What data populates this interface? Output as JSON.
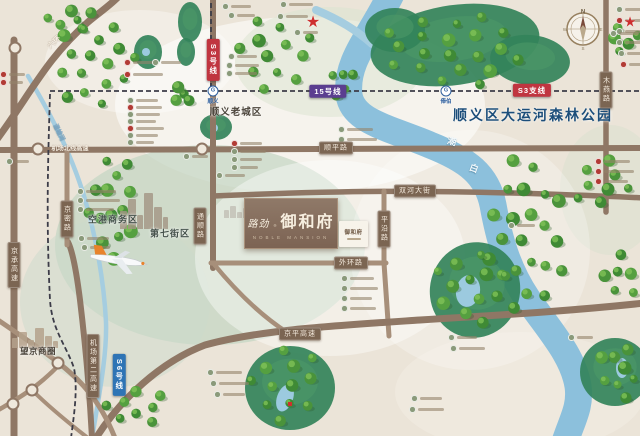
{
  "meta": {
    "title": "路劲御和府 区位示意图"
  },
  "brand": {
    "prefix": "路劲",
    "reg": "®",
    "name": "御和府",
    "en": "NOBLE MANSION",
    "card_name": "御和府"
  },
  "compass": {
    "n": "N",
    "e": "E",
    "s": "S",
    "w": "W"
  },
  "region_labels": [
    {
      "text": "顺义老城区",
      "x": 236,
      "y": 111,
      "size": 9.5,
      "color": "#4a4339",
      "ls": 1
    },
    {
      "text": "顺义区大运河森林公园",
      "x": 533,
      "y": 115,
      "size": 14,
      "color": "#1c4e7a",
      "ls": 2
    },
    {
      "text": "空港商务区",
      "x": 113,
      "y": 219,
      "size": 9,
      "color": "#44514a",
      "ls": 1
    },
    {
      "text": "第七街区",
      "x": 170,
      "y": 233,
      "size": 9,
      "color": "#44514a",
      "ls": 1
    },
    {
      "text": "望京商圈",
      "x": 38,
      "y": 351,
      "size": 8.5,
      "color": "#4a4339",
      "ls": 0.5
    }
  ],
  "river_labels": [
    {
      "text": "潮",
      "x": 452,
      "y": 141,
      "rot": 15,
      "size": 9
    },
    {
      "text": "白",
      "x": 474,
      "y": 168,
      "rot": 20,
      "size": 9
    },
    {
      "text": "温榆河",
      "x": 60,
      "y": 132,
      "rot": 64,
      "size": 6
    }
  ],
  "road_pills": [
    {
      "text": "顺平路",
      "x": 336,
      "y": 148,
      "v": false
    },
    {
      "text": "双河大街",
      "x": 415,
      "y": 191,
      "v": false
    },
    {
      "text": "外环路",
      "x": 351,
      "y": 263,
      "v": false
    },
    {
      "text": "京平高速",
      "x": 300,
      "y": 334,
      "v": false
    },
    {
      "text": "京承高速",
      "x": 14,
      "y": 265,
      "v": true
    },
    {
      "text": "京密路",
      "x": 67,
      "y": 219,
      "v": true
    },
    {
      "text": "通顺路",
      "x": 200,
      "y": 226,
      "v": true
    },
    {
      "text": "机场第二高速",
      "x": 93,
      "y": 366,
      "v": true
    },
    {
      "text": "平沿路",
      "x": 384,
      "y": 229,
      "v": true
    },
    {
      "text": "木燕路",
      "x": 606,
      "y": 90,
      "v": true
    }
  ],
  "road_texts": [
    {
      "text": "六环",
      "x": 54,
      "y": 42,
      "rot": -42,
      "size": 7.5
    },
    {
      "text": "机场北线高速",
      "x": 70,
      "y": 148,
      "rot": 0,
      "size": 6.2
    }
  ],
  "metro_pills": [
    {
      "text": "S3号线",
      "x": 213,
      "y": 60,
      "v": true,
      "bg": "#c03540"
    },
    {
      "text": "15号线",
      "x": 328,
      "y": 91,
      "v": false,
      "bg": "#5b3e90"
    },
    {
      "text": "S3支线",
      "x": 532,
      "y": 90,
      "v": false,
      "bg": "#c03540"
    },
    {
      "text": "S6号线",
      "x": 119,
      "y": 375,
      "v": true,
      "bg": "#2e74b5"
    }
  ],
  "stations": [
    {
      "name": "顺义",
      "x": 213,
      "y": 91
    },
    {
      "name": "俸伯",
      "x": 446,
      "y": 91
    }
  ],
  "stars": [
    {
      "x": 313,
      "y": 22,
      "s": 16
    },
    {
      "x": 630,
      "y": 22,
      "s": 14
    }
  ],
  "palette": {
    "bg": "#ebe4d8",
    "road": "#8f7765",
    "road_minor": "#a78f7a",
    "river": "#8cc0dc",
    "stream": "#a5cde0",
    "park": "#33835a",
    "park_light": "#4f9a68",
    "pond": "#9ccadf",
    "tree_shadow": "#2b5a28",
    "tree": [
      "#3f8a35",
      "#55a040",
      "#4a933b"
    ],
    "tree_hi": "#7fc258",
    "metro_dash": "#3c3c48",
    "accent_red": "#ce2f2f"
  },
  "geometry": {
    "zones": [
      [
        300,
        105,
        185,
        88,
        "#ffffff",
        0.55,
        0
      ],
      [
        330,
        62,
        95,
        55,
        "#d9e3cf",
        0.5,
        0
      ],
      [
        210,
        245,
        155,
        100,
        "#c3d6c4",
        0.72,
        0
      ],
      [
        115,
        302,
        95,
        85,
        "#cbdacb",
        0.5,
        0
      ],
      [
        330,
        258,
        135,
        98,
        "#ffffff",
        0.4,
        0
      ],
      [
        610,
        190,
        50,
        65,
        "#d5dfcc",
        0.4,
        0
      ],
      [
        140,
        62,
        95,
        52,
        "#ffffff",
        0.35,
        0
      ],
      [
        520,
        392,
        125,
        60,
        "#f3ede3",
        0.5,
        0
      ],
      [
        470,
        250,
        120,
        120,
        "#ffffff",
        0.25,
        0
      ]
    ],
    "rivers": [
      [
        "M393,-10 C372,35 345,60 349,95 C353,122 390,128 430,145 C468,160 487,175 493,205 C499,238 507,268 527,298 C549,330 573,355 578,386 C581,407 572,420 565,442",
        27,
        "river"
      ],
      [
        "M316,10 C340,20 356,30 372,44",
        8,
        "stream"
      ],
      [
        "M28,76 C48,110 70,150 84,196 C96,236 104,282 106,322 C107,354 100,390 92,438",
        4.5,
        "stream"
      ]
    ],
    "parks": [
      [
        455,
        45,
        85,
        40,
        -8
      ],
      [
        395,
        30,
        30,
        22,
        0
      ],
      [
        530,
        60,
        40,
        25,
        5
      ],
      [
        190,
        22,
        12,
        20,
        0
      ],
      [
        186,
        52,
        9,
        14,
        0
      ],
      [
        216,
        127,
        16,
        13,
        0
      ],
      [
        148,
        52,
        14,
        17,
        0
      ],
      [
        475,
        290,
        45,
        48,
        15
      ],
      [
        290,
        388,
        45,
        42,
        0
      ],
      [
        615,
        372,
        35,
        34,
        0
      ]
    ],
    "ponds": [
      [
        214,
        128,
        4,
        4,
        0
      ],
      [
        146,
        52,
        4,
        4,
        0
      ],
      [
        468,
        291,
        12,
        16,
        10
      ],
      [
        285,
        398,
        8,
        14,
        20
      ],
      [
        622,
        368,
        6,
        10,
        0
      ]
    ],
    "roads": [
      [
        "M-5,142 C30,95 45,60 88,22 C100,12 112,4 120,-5",
        7
      ],
      [
        "M14,40 L14,438",
        7
      ],
      [
        "M-5,150 L645,148",
        6
      ],
      [
        "M213,-5 L213,268",
        6
      ],
      [
        "M606,-5 L606,212",
        5.5
      ],
      [
        "M213,196 C330,191 430,188 645,198",
        5.5
      ],
      [
        "M384,191 L384,263 L389,336",
        5
      ],
      [
        "M211,263 L386,263",
        5
      ],
      [
        "M96,438 C120,400 160,362 205,345 C260,330 330,326 420,320 C520,314 580,310 645,303",
        7
      ],
      [
        "M92,438 C90,400 86,350 80,300 C76,268 72,250 68,242",
        6
      ],
      [
        "M67,150 L67,245",
        5
      ],
      [
        "M-5,318 C20,335 45,352 60,364 C80,380 100,400 115,438",
        5
      ],
      [
        "M-5,412 C15,400 35,390 60,364",
        4.5
      ],
      [
        "M32,390 C50,408 70,424 88,438",
        4
      ],
      [
        "M213,263 C235,290 260,315 288,333",
        4.5
      ]
    ],
    "junctions": [
      [
        15,
        48
      ],
      [
        38,
        149
      ],
      [
        202,
        149
      ],
      [
        58,
        363
      ],
      [
        32,
        390
      ],
      [
        13,
        404
      ]
    ],
    "metro_paths": [
      "M50,91 L645,91",
      "M211,-5 L211,88",
      "M50,94 C48,160 46,220 50,300 C52,330 66,345 74,368 C78,390 74,415 71,438"
    ],
    "forests": [
      [
        70,
        20,
        26,
        14,
        6
      ],
      [
        625,
        40,
        20,
        14,
        5
      ],
      [
        455,
        50,
        75,
        38,
        20
      ],
      [
        276,
        55,
        44,
        38,
        12
      ],
      [
        95,
        62,
        42,
        48,
        16
      ],
      [
        342,
        80,
        14,
        18,
        5
      ],
      [
        180,
        95,
        12,
        10,
        4
      ],
      [
        602,
        185,
        32,
        26,
        8
      ],
      [
        112,
        205,
        26,
        55,
        14
      ],
      [
        527,
        235,
        40,
        85,
        22
      ],
      [
        622,
        276,
        18,
        28,
        6
      ],
      [
        470,
        288,
        38,
        42,
        12
      ],
      [
        620,
        372,
        22,
        30,
        8
      ],
      [
        285,
        382,
        38,
        40,
        12
      ],
      [
        135,
        408,
        32,
        22,
        8
      ]
    ],
    "skylines": [
      {
        "x": 12,
        "base": 348,
        "w": [
          6,
          8,
          6,
          9,
          7,
          5
        ],
        "h": [
          10,
          16,
          8,
          20,
          12,
          7
        ],
        "c": "#b5a28c",
        "op": 0.85
      },
      {
        "x": 120,
        "base": 229,
        "w": [
          7,
          8,
          6,
          9,
          8,
          5
        ],
        "h": [
          18,
          30,
          14,
          36,
          22,
          12
        ],
        "c": "#a39584",
        "op": 0.8
      },
      {
        "x": 224,
        "base": 218,
        "w": [
          5,
          6,
          5,
          6
        ],
        "h": [
          8,
          12,
          6,
          10
        ],
        "c": "#a9a096",
        "op": 0.45
      }
    ],
    "pois": [
      [
        126,
        61,
        "r",
        26
      ],
      [
        154,
        61,
        "g",
        20
      ],
      [
        126,
        73,
        "r",
        30
      ],
      [
        129,
        99,
        "g",
        22
      ],
      [
        129,
        106,
        "r",
        26
      ],
      [
        129,
        113,
        "g",
        24
      ],
      [
        129,
        120,
        "g",
        20
      ],
      [
        129,
        127,
        "r",
        28
      ],
      [
        129,
        134,
        "g",
        22
      ],
      [
        129,
        141,
        "g",
        18
      ],
      [
        230,
        55,
        "g",
        20
      ],
      [
        228,
        64,
        "g",
        24
      ],
      [
        228,
        72,
        "g",
        22
      ],
      [
        233,
        142,
        "r",
        22
      ],
      [
        233,
        150,
        "g",
        26
      ],
      [
        233,
        158,
        "g",
        22
      ],
      [
        233,
        166,
        "g",
        18
      ],
      [
        218,
        174,
        "g",
        20
      ],
      [
        340,
        128,
        "g",
        26
      ],
      [
        340,
        138,
        "g",
        30
      ],
      [
        618,
        8,
        "g",
        22
      ],
      [
        618,
        19,
        "r",
        24
      ],
      [
        618,
        30,
        "g",
        20
      ],
      [
        618,
        41,
        "g",
        22
      ],
      [
        620,
        52,
        "g",
        18
      ],
      [
        622,
        63,
        "r",
        18
      ],
      [
        597,
        160,
        "r",
        26
      ],
      [
        597,
        170,
        "r",
        30
      ],
      [
        597,
        180,
        "r",
        24
      ],
      [
        510,
        224,
        "g",
        18
      ],
      [
        343,
        277,
        "g",
        24
      ],
      [
        343,
        287,
        "g",
        28
      ],
      [
        343,
        297,
        "g",
        22
      ],
      [
        343,
        307,
        "g",
        26
      ],
      [
        450,
        336,
        "g",
        20
      ],
      [
        452,
        347,
        "g",
        26
      ],
      [
        413,
        397,
        "g",
        22
      ],
      [
        411,
        408,
        "g",
        26
      ],
      [
        209,
        371,
        "g",
        26
      ],
      [
        212,
        382,
        "g",
        30
      ],
      [
        216,
        393,
        "g",
        22
      ],
      [
        570,
        336,
        "g",
        16
      ],
      [
        224,
        5,
        "g",
        20
      ],
      [
        230,
        14,
        "g",
        18
      ],
      [
        282,
        3,
        "g",
        24
      ],
      [
        279,
        15,
        "g",
        22
      ],
      [
        296,
        31,
        "g",
        15
      ],
      [
        612,
        32,
        "g",
        20
      ],
      [
        2,
        73,
        "r",
        16
      ],
      [
        2,
        81,
        "r",
        14
      ],
      [
        185,
        155,
        "g",
        16
      ],
      [
        8,
        160,
        "g",
        14
      ],
      [
        79,
        190,
        "g",
        30
      ],
      [
        79,
        199,
        "g",
        34
      ],
      [
        79,
        208,
        "g",
        28
      ],
      [
        80,
        237,
        "g",
        22
      ],
      [
        83,
        246,
        "g",
        20
      ]
    ],
    "pavilion": [
      290,
      404
    ]
  }
}
